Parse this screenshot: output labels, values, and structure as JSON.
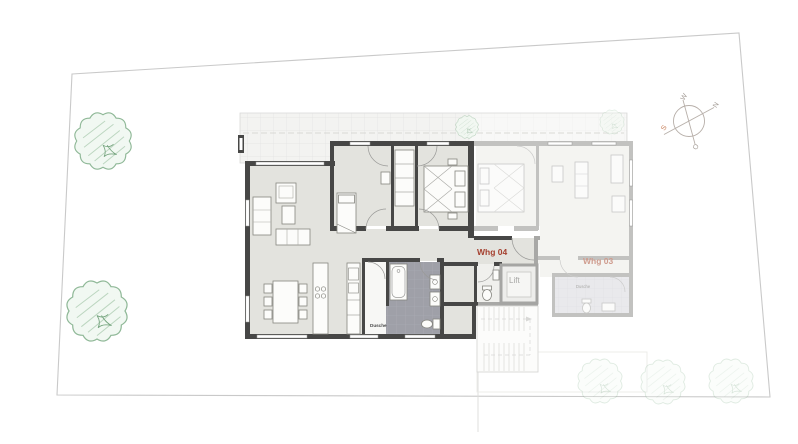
{
  "labels": {
    "apartment_active": "Whg 04",
    "apartment_ghost": "Whg 03",
    "lift": "Lift",
    "shower_active": "Dusche",
    "shower_ghost": "Dusche"
  },
  "compass": {
    "north": "N",
    "south": "S",
    "west": "W",
    "east": "O"
  },
  "colors": {
    "apartment_active_label": "#a5402f",
    "apartment_ghost_label": "#cf9c8e",
    "compass_south": "#c47a52",
    "wall": "#474746",
    "floor": "#e3e3de",
    "bath_tile": "#9fa0a8",
    "tree": "#8fb897",
    "boundary": "#c9c9c9"
  }
}
